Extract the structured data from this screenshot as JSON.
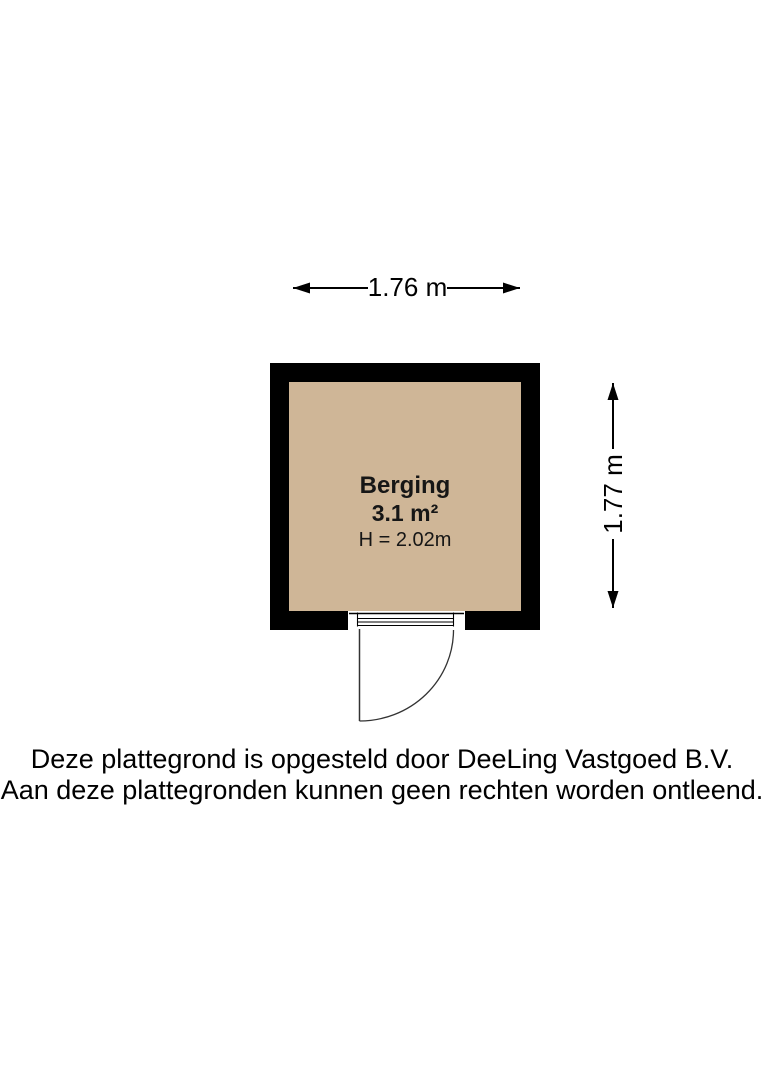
{
  "floorplan": {
    "room": {
      "name": "Berging",
      "area": "3.1 m²",
      "ceiling_height": "H = 2.02m"
    },
    "dimensions": {
      "width_label": "1.76 m",
      "height_label": "1.77 m"
    },
    "colors": {
      "floor": "#cfb697",
      "wall": "#000000",
      "line": "#000000"
    }
  },
  "footer": {
    "line1": "Deze plattegrond is opgesteld door DeeLing Vastgoed B.V.",
    "line2": "Aan deze plattegronden kunnen geen rechten worden ontleend."
  }
}
